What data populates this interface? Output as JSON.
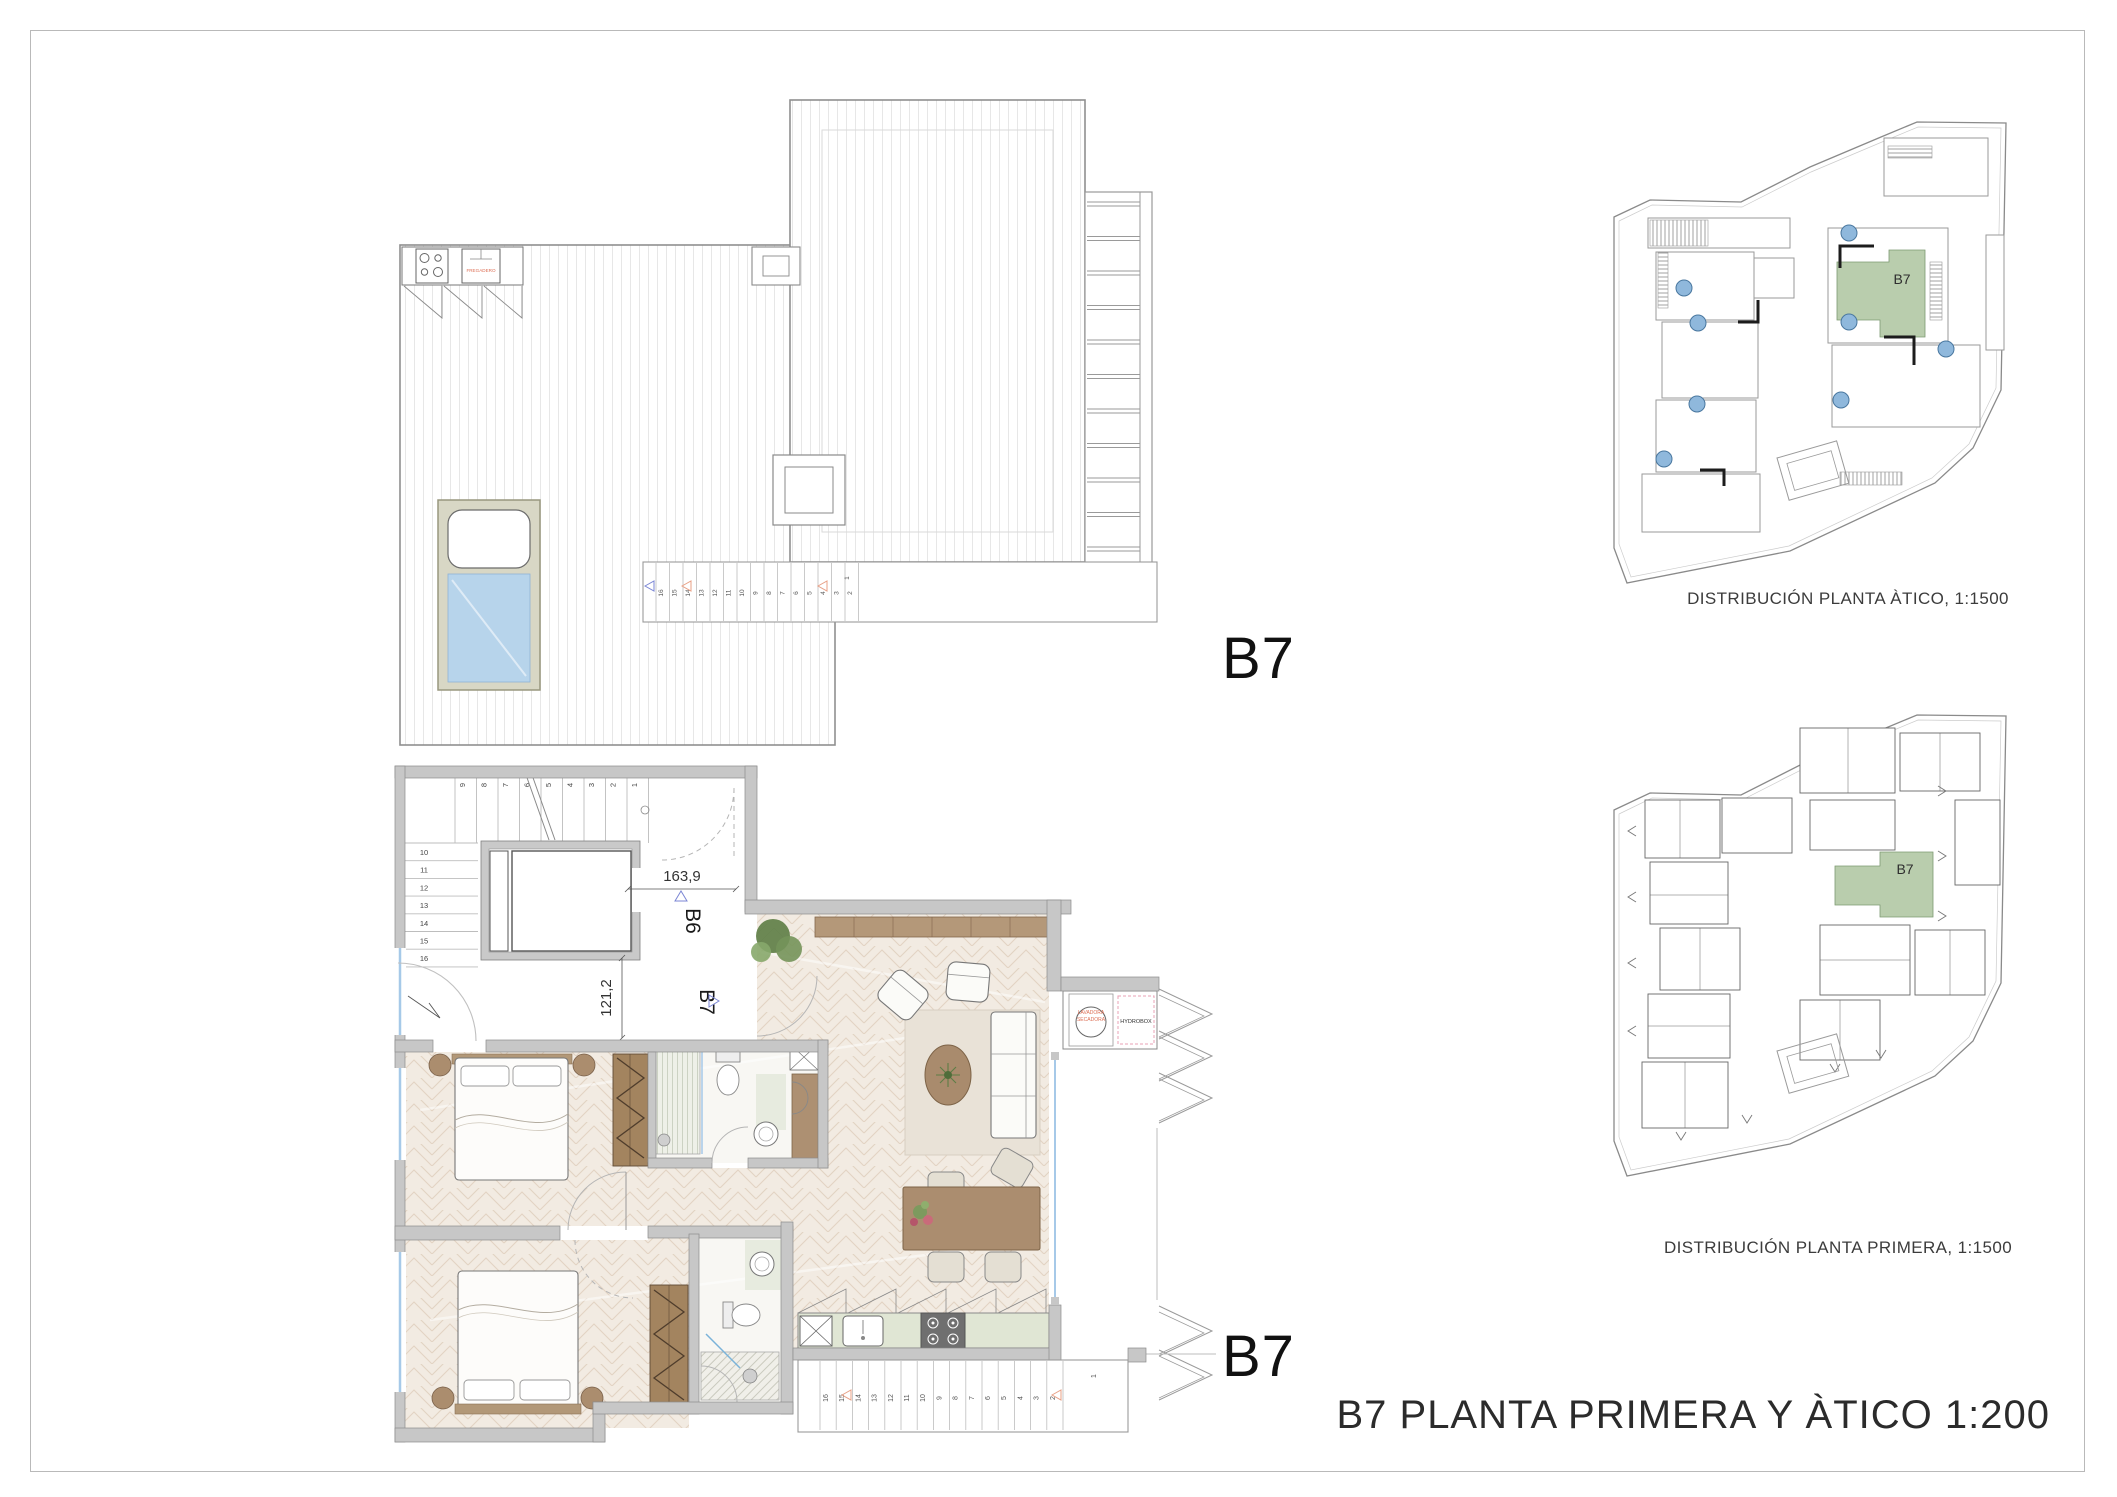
{
  "page": {
    "title": "B7 PLANTA PRIMERA Y ÀTICO 1:200",
    "unit_label_top": "B7",
    "unit_label_bottom": "B7"
  },
  "atico_plan": {
    "kitchen_sink_label": "FREGADERO",
    "stair_numbers": [
      "16",
      "15",
      "14",
      "13",
      "12",
      "11",
      "10",
      "9",
      "8",
      "7",
      "6",
      "5",
      "4",
      "3",
      "2"
    ],
    "stair_landing_number": "1"
  },
  "primera_plan": {
    "dim_width": "163,9",
    "dim_height": "121,2",
    "unit_b6_label": "B6",
    "unit_b7_label": "B7",
    "interior_stair_top_numbers": [
      "9",
      "8",
      "7",
      "6",
      "5",
      "4",
      "3",
      "2",
      "1"
    ],
    "interior_stair_side_numbers": [
      "10",
      "11",
      "12",
      "13",
      "14",
      "15",
      "16"
    ],
    "exterior_stair_numbers": [
      "16",
      "15",
      "14",
      "13",
      "12",
      "11",
      "10",
      "9",
      "8",
      "7",
      "6",
      "5",
      "4",
      "3",
      "2"
    ],
    "exterior_stair_landing_number": "1",
    "washer_label_line1": "LAVADORA",
    "washer_label_line2": "SECADORA",
    "hydrobox_label": "HYDROBOX"
  },
  "site_plans": {
    "atico": {
      "caption": "DISTRIBUCIÓN PLANTA ÀTICO, 1:1500",
      "highlight_label": "B7"
    },
    "primera": {
      "caption": "DISTRIBUCIÓN PLANTA PRIMERA, 1:1500",
      "highlight_label": "B7"
    }
  },
  "colors": {
    "highlight_green": "#b9cdad",
    "pool_water": "#b7d4eb",
    "site_pool_blue": "#8fb8dc",
    "accent_red": "#dd6f55",
    "window_blue": "#a6c9e8",
    "wall_grey": "#c7c7c7",
    "parquet_beige": "#f2ebe2",
    "furniture_brown": "#a98b6d",
    "counter_green": "#e0e6d4"
  }
}
